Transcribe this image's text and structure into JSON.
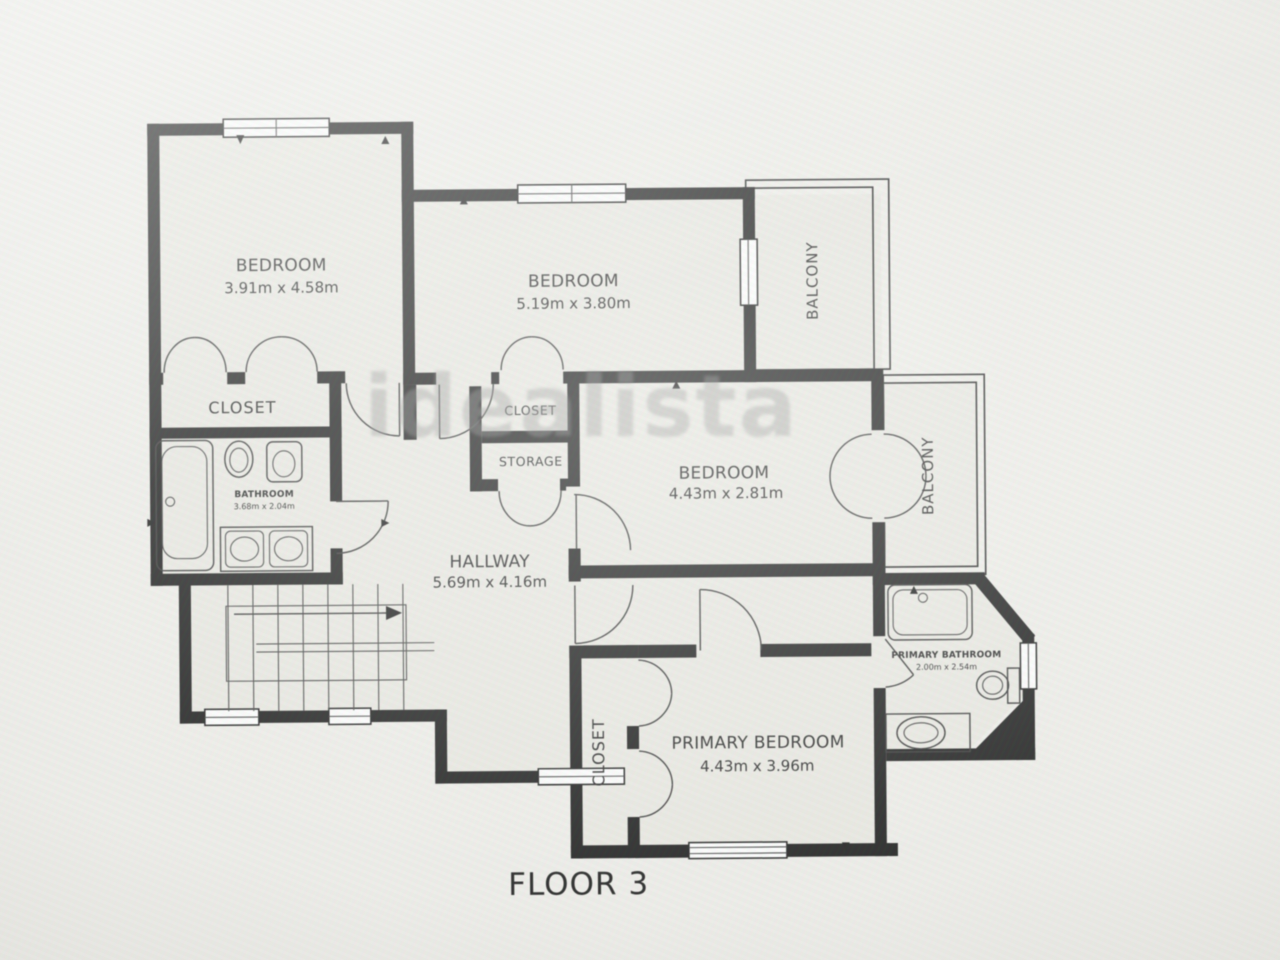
{
  "floor_label": "FLOOR 3",
  "watermark": "idealista",
  "colors": {
    "walls": "#202020",
    "floor": "#ebeae4",
    "background": "#edece8",
    "label_text": "#2c2c2c",
    "watermark": "#8a8a8a"
  },
  "rooms": {
    "bedroom1": {
      "name": "BEDROOM",
      "dims": "3.91m x 4.58m"
    },
    "bedroom2": {
      "name": "BEDROOM",
      "dims": "5.19m x 3.80m"
    },
    "bedroom3": {
      "name": "BEDROOM",
      "dims": "4.43m x 2.81m"
    },
    "primary_bedroom": {
      "name": "PRIMARY BEDROOM",
      "dims": "4.43m x 3.96m"
    },
    "hallway": {
      "name": "HALLWAY",
      "dims": "5.69m x 4.16m"
    },
    "bathroom": {
      "name": "BATHROOM",
      "dims": "3.68m x 2.04m"
    },
    "primary_bathroom": {
      "name": "PRIMARY BATHROOM",
      "dims": "2.00m x 2.54m"
    },
    "closet_left": {
      "name": "CLOSET"
    },
    "closet_mid": {
      "name": "CLOSET"
    },
    "storage": {
      "name": "STORAGE"
    },
    "closet_primary": {
      "name": "CLOSET"
    },
    "balcony_top": {
      "name": "BALCONY"
    },
    "balcony_right": {
      "name": "BALCONY"
    }
  }
}
